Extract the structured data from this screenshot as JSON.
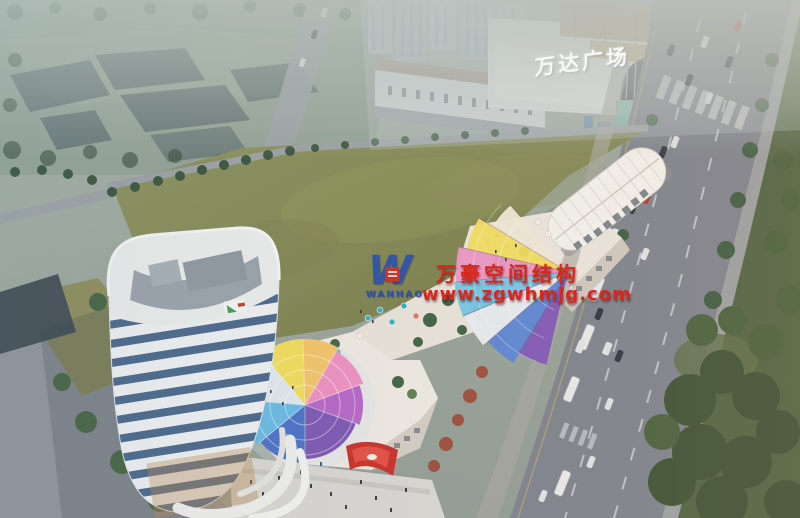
{
  "signs": {
    "mall_roof_sign": "万达广场"
  },
  "watermark": {
    "logo_monogram": "W",
    "logo_wordmark": "WANHAO",
    "line1": "万豪空间结构",
    "line2": "www.zgwhmjg.com"
  },
  "colors": {
    "watermark_red": "#d8281c",
    "watermark_blue": "#2b50b4",
    "sign_white": "#f6f8f6",
    "lawn_green": "#81874f",
    "park_green": "#42543a",
    "road_grey": "#7d838e",
    "tower_band_white": "#edf1f4",
    "tower_glass_blue": "#46658a",
    "canopy_blue": "#5b86d8",
    "canopy_cyan": "#74c6e6",
    "canopy_yellow": "#f1dd5e",
    "canopy_pink": "#ea96c4",
    "canopy_purple": "#8057ba",
    "haze_blue": "#b7c3bd"
  }
}
